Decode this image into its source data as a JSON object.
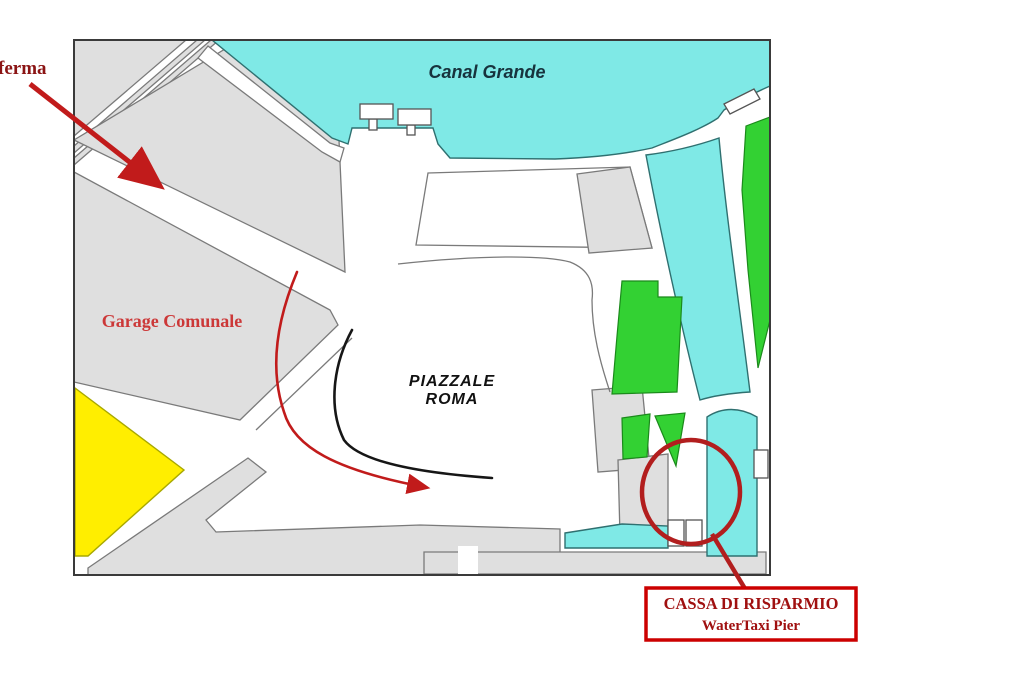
{
  "map": {
    "labels": {
      "terraferma_fragment": "ferma",
      "canal_grande": "Canal Grande",
      "garage_comunale": "Garage Comunale",
      "piazzale_line1": "PIAZZALE",
      "piazzale_line2": "ROMA",
      "callout_line1": "CASSA DI RISPARMIO",
      "callout_line2": "WaterTaxi Pier"
    },
    "colors": {
      "water": "#7fe9e6",
      "land_gray": "#dfdfdf",
      "green_area": "#33d133",
      "yellow_area": "#ffee00",
      "red_annotation": "#c11b1b",
      "red_dark_circle": "#b21e1e",
      "callout_border": "#cc0000",
      "callout_text": "#a01010",
      "garage_label_red": "#cc3838",
      "dark_map_text": "#17333d"
    }
  }
}
